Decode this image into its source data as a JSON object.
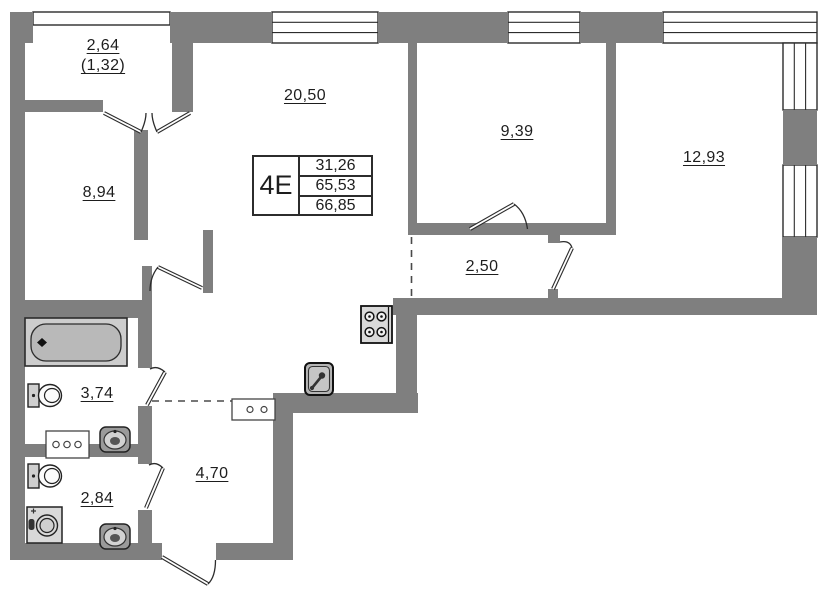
{
  "unit": {
    "label": "4E",
    "stats": [
      "31,26",
      "65,53",
      "66,85"
    ]
  },
  "rooms": {
    "balcony": {
      "area": "2,64",
      "reduced_area": "(1,32)"
    },
    "living_kitchen": {
      "area": "20,50"
    },
    "bedroom_small": {
      "area": "9,39"
    },
    "bedroom_large": {
      "area": "12,93"
    },
    "room": {
      "area": "8,94"
    },
    "corridor": {
      "area": "2,50"
    },
    "bathroom": {
      "area": "3,74"
    },
    "wc": {
      "area": "2,84"
    },
    "hall": {
      "area": "4,70"
    }
  },
  "colors": {
    "wall": "#7f7f7f",
    "line": "#2c2c2c",
    "fixture": "#d9d9d9",
    "tub": "#b9b9b9",
    "bg": "#ffffff"
  },
  "icons": [
    "bathtub-icon",
    "toilet-icon",
    "sink-icon",
    "washing-machine-icon",
    "stove-icon",
    "kitchen-sink-icon",
    "counter-icon",
    "window-glazing",
    "door-swing"
  ]
}
